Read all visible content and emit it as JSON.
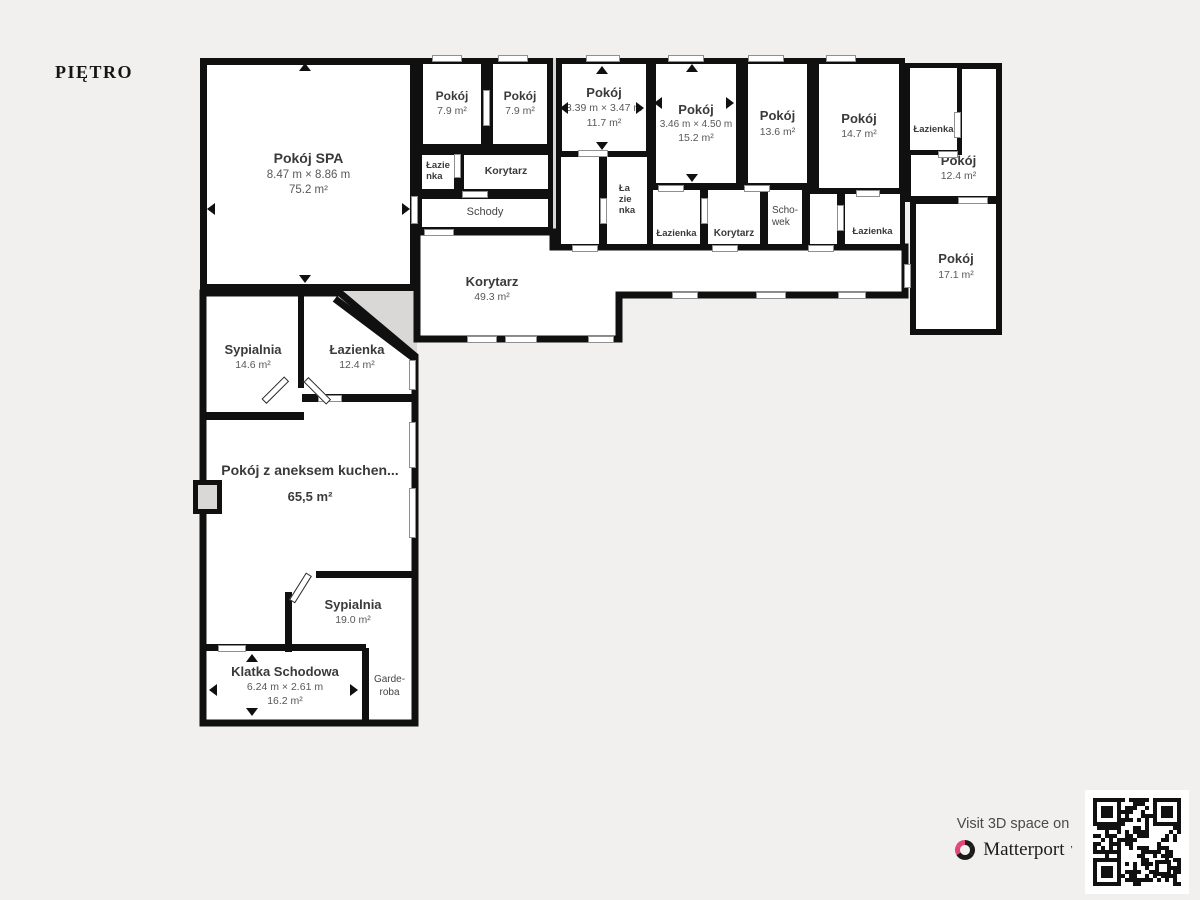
{
  "title": "PIĘTRO",
  "colors": {
    "background": "#f1f0ee",
    "walls": "#101010",
    "shading": "#d9d8d6",
    "matterport_pink": "#e0457b"
  },
  "rooms": {
    "spa": {
      "name": "Pokój SPA",
      "dims": "8.47 m × 8.86 m",
      "area": "75.2 m²"
    },
    "pokoj_79a": {
      "name": "Pokój",
      "area": "7.9 m²"
    },
    "pokoj_79b": {
      "name": "Pokój",
      "area": "7.9 m²"
    },
    "lazienka_tl": {
      "name": "Łazie\nnka"
    },
    "korytarz_top": {
      "name": "Korytarz"
    },
    "schody": {
      "name": "Schody"
    },
    "pokoj_117": {
      "name": "Pokój",
      "dims": "3.39 m × 3.47 m",
      "area": "11.7 m²"
    },
    "lazienka_mid": {
      "name": "Ła\nzie\nnka"
    },
    "pokoj_152": {
      "name": "Pokój",
      "dims": "3.46 m × 4.50 m",
      "area": "15.2 m²"
    },
    "pokoj_136": {
      "name": "Pokój",
      "area": "13.6 m²"
    },
    "pokoj_147": {
      "name": "Pokój",
      "area": "14.7 m²"
    },
    "lazienka_152": {
      "name": "Łazienka"
    },
    "korytarz_mid": {
      "name": "Korytarz"
    },
    "schowek": {
      "name": "Scho-\nwek"
    },
    "lazienka_147": {
      "name": "Łazienka"
    },
    "lazienka_tr": {
      "name": "Łazienka"
    },
    "pokoj_124r": {
      "name": "Pokój",
      "area": "12.4 m²"
    },
    "pokoj_171": {
      "name": "Pokój",
      "area": "17.1 m²"
    },
    "korytarz_main": {
      "name": "Korytarz",
      "area": "49.3 m²"
    },
    "sypialnia_146": {
      "name": "Sypialnia",
      "area": "14.6 m²"
    },
    "lazienka_124": {
      "name": "Łazienka",
      "area": "12.4 m²"
    },
    "pokoj_aneks": {
      "name": "Pokój z aneksem kuchen...",
      "area": "65,5 m²"
    },
    "sypialnia_190": {
      "name": "Sypialnia",
      "area": "19.0 m²"
    },
    "klatka": {
      "name": "Klatka Schodowa",
      "dims": "6.24 m × 2.61 m",
      "area": "16.2 m²"
    },
    "garderoba": {
      "name": "Garde-\nroba"
    }
  },
  "footer": {
    "visit_text": "Visit 3D space on",
    "brand": "Matterport"
  }
}
